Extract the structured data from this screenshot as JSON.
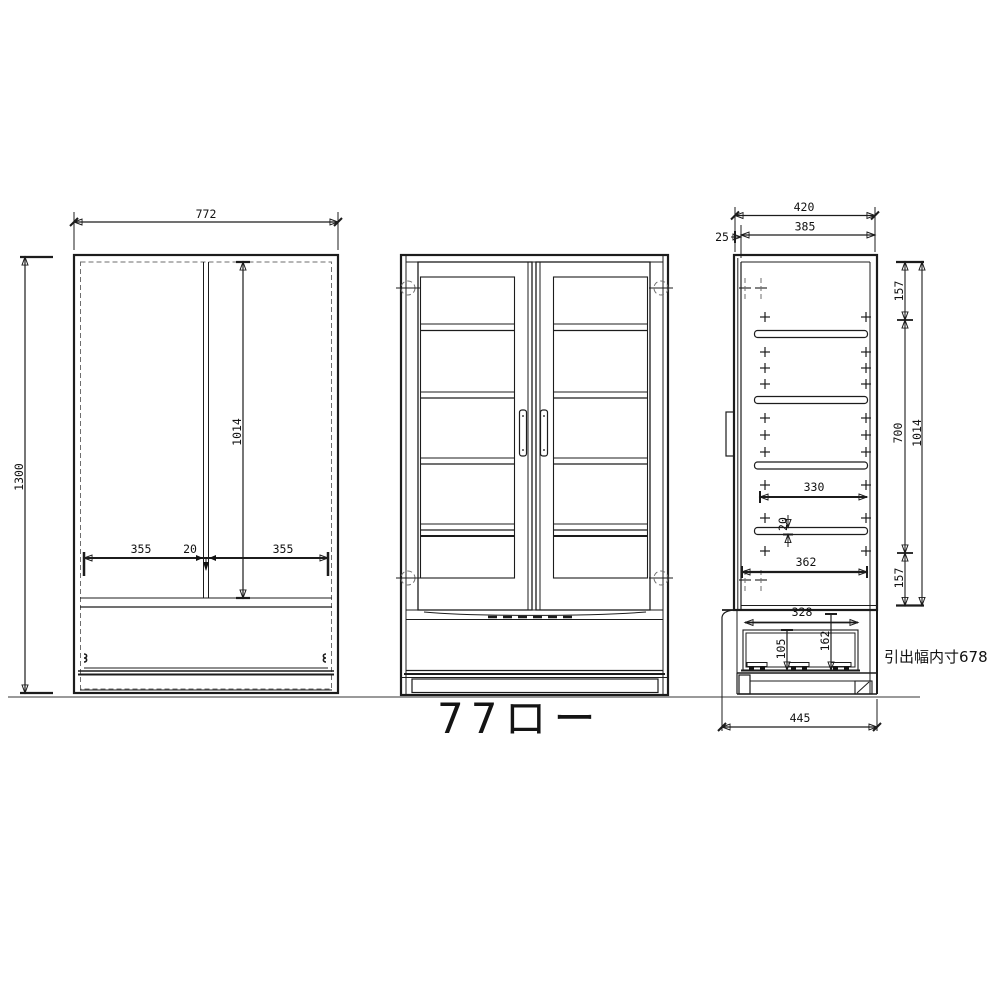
{
  "title": "77ロー",
  "annotation": "引出幅内寸678",
  "front_view": {
    "overall_width": "772",
    "overall_height": "1300",
    "interior_height": "1014",
    "left_opening": "355",
    "center_divider": "20",
    "right_opening": "355"
  },
  "side_view": {
    "overall_depth": "420",
    "inner_depth": "385",
    "front_offset": "25",
    "top_space": "157",
    "middle_space": "700",
    "interior_height": "1014",
    "shelf_depth": "330",
    "shelf_thickness": "20",
    "bottom_space": "157",
    "fixed_shelf_depth": "362",
    "drawer_inner_depth": "328",
    "drawer_front_height": "162",
    "drawer_inner_height": "105",
    "base_depth": "445"
  }
}
